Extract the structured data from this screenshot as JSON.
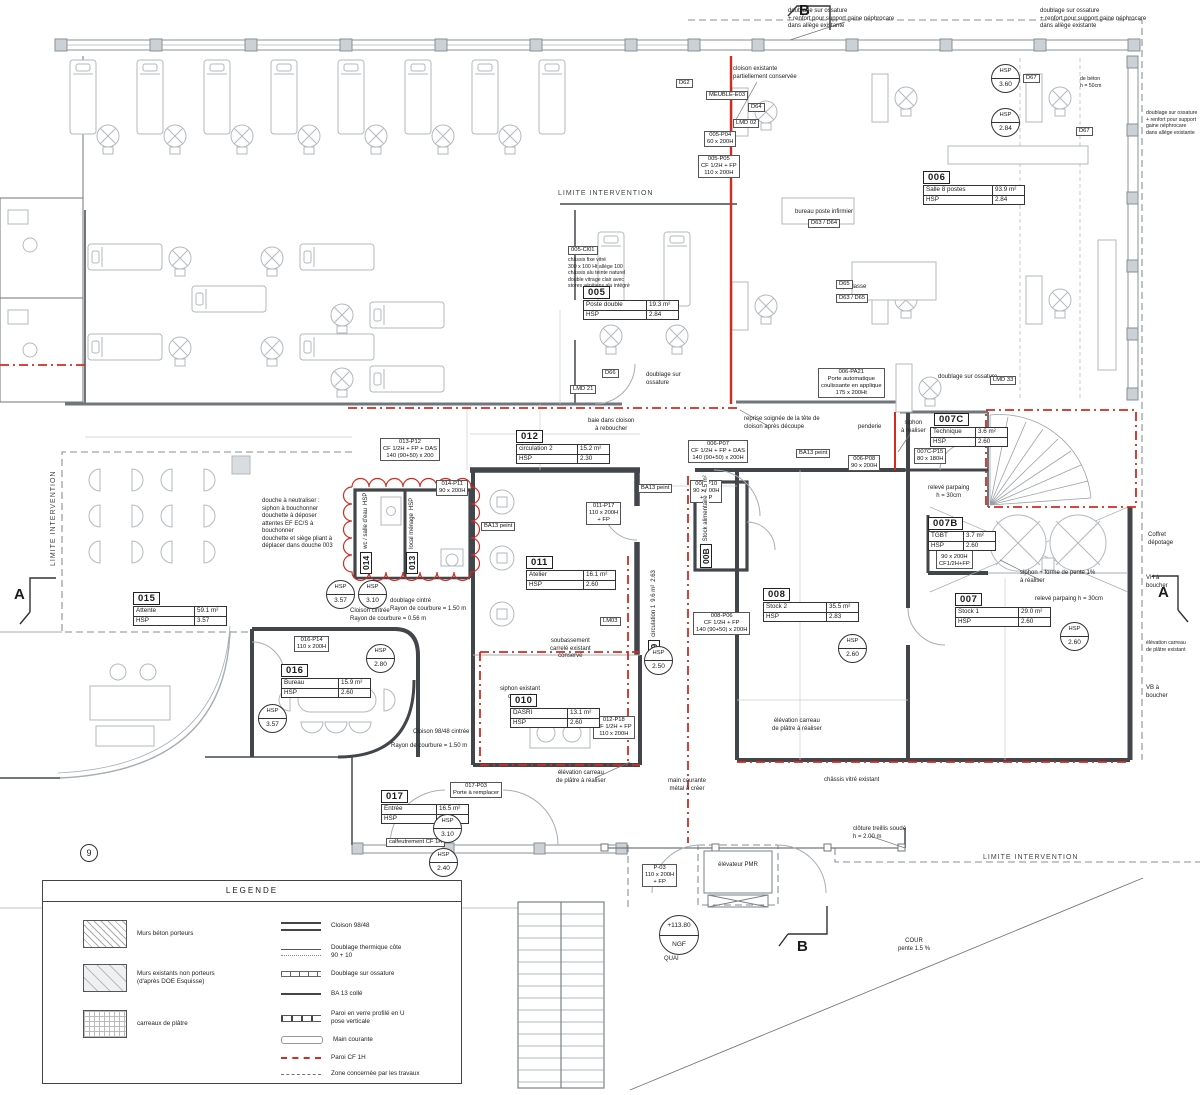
{
  "legend": {
    "title": "LEGENDE",
    "fills": [
      {
        "label": "Murs béton porteurs"
      },
      {
        "label": "Murs existants non porteurs\n(d'après DOE Esquisse)"
      },
      {
        "label": "carreaux de plâtre"
      }
    ],
    "lines": [
      {
        "label": "Cloison 98/48"
      },
      {
        "label": "Doublage thermique côte\n90 + 10"
      },
      {
        "label": "Doublage sur ossature"
      },
      {
        "label": "BA 13 collé"
      },
      {
        "label": "Paroi en verre profilé en U\npose verticale"
      },
      {
        "label": "Main courante"
      },
      {
        "label": "Paroi CF 1H"
      },
      {
        "label": "Zone concernée par les travaux"
      }
    ]
  },
  "labels": {
    "hsp": "HSP"
  },
  "rooms": {
    "r005": {
      "num": "005",
      "name": "Poste double",
      "area": "19.3 m²",
      "hsp": "2.84"
    },
    "r006": {
      "num": "006",
      "name": "Salle 8 postes",
      "area": "93.9 m²",
      "hsp": "2.84"
    },
    "r007": {
      "num": "007",
      "name": "Stock 1",
      "area": "29.0 m²",
      "hsp": "2.60"
    },
    "r007b": {
      "num": "007B",
      "name": "TGBT",
      "area": "3.7 m²",
      "hsp": "2.60"
    },
    "r007c": {
      "num": "007C",
      "name": "Technique",
      "area": "3.6 m²",
      "hsp": "2.60"
    },
    "r008": {
      "num": "008",
      "name": "Stock 2",
      "area": "35.5 m²",
      "hsp": "2.83"
    },
    "r008b": {
      "num": "00B",
      "name": "Stock alimentaire",
      "area": "4.5 m²",
      "hsp": "2.60"
    },
    "r009": {
      "num": "009",
      "name": "circulation 1",
      "area": "9.6 m²",
      "hsp": "2.63"
    },
    "r010": {
      "num": "010",
      "name": "DASRI",
      "area": "13.1 m²",
      "hsp": "2.60"
    },
    "r011": {
      "num": "011",
      "name": "Atelier",
      "area": "16.1 m²",
      "hsp": "2.60"
    },
    "r012": {
      "num": "012",
      "name": "circulation 2",
      "area": "15.2 m²",
      "hsp": "2.30"
    },
    "r013": {
      "num": "013",
      "name": "local ménage"
    },
    "r014": {
      "num": "014",
      "name": "wc / salle d'eau"
    },
    "r015": {
      "num": "015",
      "name": "Attente",
      "area": "59.1 m²",
      "hsp": "3.57"
    },
    "r016": {
      "num": "016",
      "name": "Bureau",
      "area": "15.9 m²",
      "hsp": "2.60"
    },
    "r017": {
      "num": "017",
      "name": "Entrée",
      "area": "16.5 m²",
      "hsp": "3.10"
    }
  },
  "bubbles": {
    "b1": "3.60",
    "b2": "2.84",
    "b3": "3.57",
    "b4": "3.10",
    "b5": "2.80",
    "b6": "3.57",
    "b7": "2.50",
    "b8": "2.60",
    "b9": "2.60",
    "b10": "3.10",
    "b11": "2.40"
  },
  "limits": {
    "top": "LIMITE INTERVENTION",
    "left": "LIMITE INTERVENTION",
    "bottom": "LIMITE INTERVENTION"
  },
  "markers": {
    "a": "A",
    "b": "B",
    "level": "+113.80",
    "datum": "NGF",
    "quai": "QUAI",
    "cour": "COUR\npente 1.5 %",
    "nine": "9",
    "elevator": "élévateur PMR"
  },
  "ann": {
    "cloison_exist": "cloison existante\npartiellement conservée",
    "doublage1": "doublage sur ossature\n+ renfort pour support gaine néphrocare\ndans allège existante",
    "doublage2": "doublage sur ossature\n+ renfort pour support gaine néphrocare\ndans allège existante",
    "doublage_right": "doublage sur ossature\n+ renfort pour support\ngaine néphrocare\ndans allège existante",
    "de_beton": "de béton\nh = 50cm",
    "bureau_inf": "bureau poste infirmier",
    "chassis_005": "châssis fixe vitré\n300 x 100 Ht allège 100\nchâssis alu teinte naturel\ndouble vitrage clair avec\nstores vénitiens alu intégré",
    "paillasse": "paillasse",
    "doublage_oss1": "doublage sur\nossature",
    "doublage_oss2": "doublage sur ossature",
    "baie": "baie dans cloison\nà reboucher",
    "reprise": "reprise soignée de la tête de\ncloison après découpe",
    "penderie": "penderie",
    "siphon_real": "siphon\nà réaliser",
    "releve1": "relevé parpaing\nh = 30cm",
    "releve2": "relevé parpaing h = 30cm",
    "siphon_pente": "siphon + forme de pente 1%\nà réaliser",
    "douche": "douche à neutraliser :\nsiphon à bouchonner\ndouchette à déposer\nattentes EF EC/S à\nbouchonner\ndouchette et siège pliant à\ndéplacer dans douche 003",
    "soubassement": "soubassement\ncarrelé existant\nconservé",
    "siphon_exist": "siphon existant\nconservé",
    "elev_carreau1": "élévation carreau\nde plâtre à réaliser",
    "elev_carreau2": "élévation carreau\nde plâtre à réaliser",
    "cloison_cintree": "Cloison cintrée\nRayon de courbure = 0.56 m",
    "doublage_cintre": "doublage cintré\nRayon de courbure = 1.50 m",
    "cloison_9848": "Cloison 98/48 cintrée",
    "rayon_150": "Rayon de courbure = 1.50 m",
    "chassis_exist": "châssis vitré existant",
    "main_courante": "main courante\nmétal à créer",
    "cloture": "clôture treillis soudé\nh = 2.00 m",
    "coffret": "Coffret\ndépotage",
    "vh": "VH à\nboucher",
    "vb": "VB à\nboucher",
    "elev_carreau_exist": "élévation carreau\nde plâtre existant"
  },
  "tags": {
    "d62": "D62",
    "meuble": "MEUBLE-E03",
    "d64": "D64",
    "lmd02": "LMD 02",
    "p005p04": "005-P04\n60 x 200H",
    "p005p05": "005-P05\nCF 1/2H + FP\n110 x 200H",
    "cl005": "005-Cl01",
    "d63d64": "D63 / D64",
    "d65": "D65",
    "d63d65": "D63 / D65",
    "d66": "D66",
    "d67a": "D67",
    "d67b": "D67",
    "lmd21": "LMD 21",
    "lmd33": "LMD 33",
    "lm03": "LM03",
    "pa21": "006-PA21\nPorte automatique\ncoulissante en applique\n175 x 200Ht",
    "p006p07": "006-P07\nCF 1/2H + FP + DAS\n140 (90+50) x 200H",
    "p006p08": "006-P08\n90 x 200H",
    "p007cp15": "007C-P15\n80 x 180H",
    "p007bp13": "007B-P13\n90 x 200H\nCF1/2H+FP",
    "p008p10": "008-P10\n90 x 200H\n+ FP",
    "p008p06": "008-P06\nCF 1/2H + FP\n140 (90+50) x 200H",
    "p011p17": "011-P17\n110 x 200H\n+ FP",
    "p012p18": "012-P18\nCF 1/2H + FP\n110 x 200H",
    "p013p12": "013-P12\nCF 1/2H + FP + DAS\n140 (90+50) x 200",
    "p014p11": "014-P11\n90 x 200H",
    "p016p14": "016-P14\n110 x 200H",
    "p017p03": "017-P03\nPorte à remplacer",
    "calf": "calfeutrement CF 1H",
    "p03": "P-03\n110 x 200H\n+ FP",
    "ba13a": "BA13 peint",
    "ba13b": "BA13 peint",
    "ba13c": "BA13 peint"
  }
}
